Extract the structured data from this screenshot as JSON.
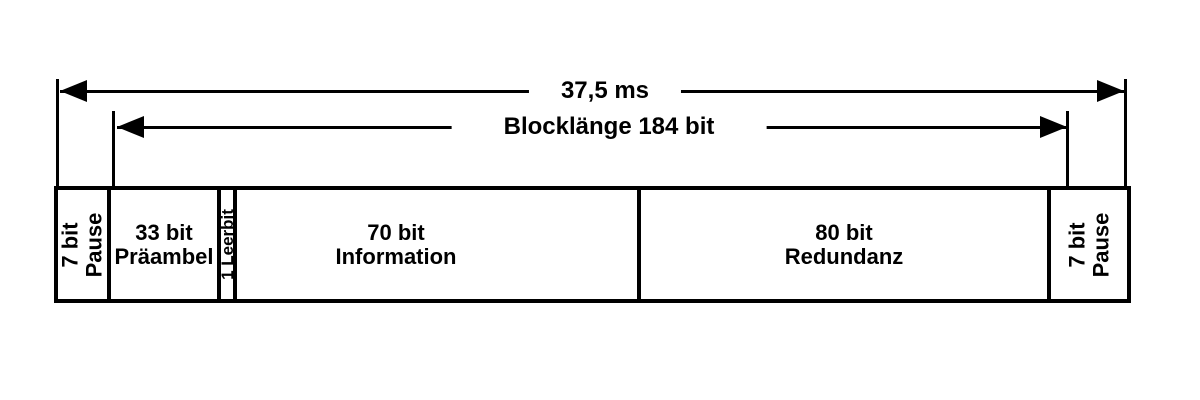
{
  "frame_diagram": {
    "colors": {
      "line": "#000000",
      "background": "#ffffff"
    },
    "dimension_arrows": [
      {
        "label": "37,5 ms"
      },
      {
        "label": "Blocklänge 184 bit"
      }
    ],
    "segments": [
      {
        "line1": "7 bit",
        "line2": "Pause"
      },
      {
        "line1": "33 bit",
        "line2": "Präambel"
      },
      {
        "line1": "1 Leerbit"
      },
      {
        "line1": "70 bit",
        "line2": "Information"
      },
      {
        "line1": "80 bit",
        "line2": "Redundanz"
      },
      {
        "line1": "7 bit",
        "line2": "Pause"
      }
    ]
  }
}
